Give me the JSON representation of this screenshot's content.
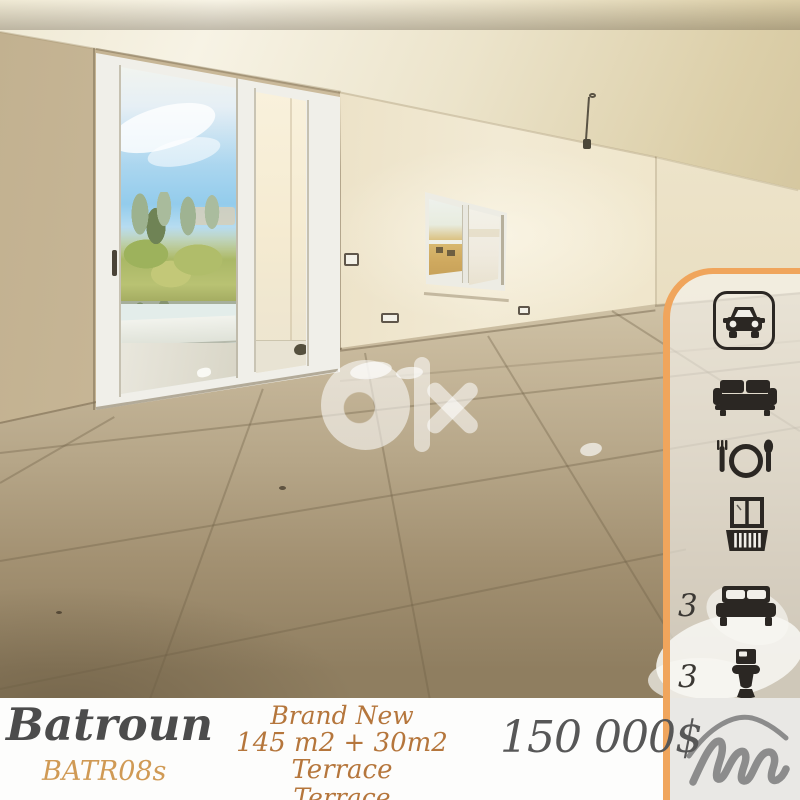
{
  "watermark": {
    "text": "Olx"
  },
  "listing": {
    "location": "Batroun",
    "reference": "BATR08s",
    "description_lines": [
      "Brand New",
      "145 m2 + 30m2 Terrace",
      "Terrace"
    ],
    "price": "150 000$"
  },
  "features": {
    "bedrooms": "3",
    "bathrooms": "3",
    "icons": [
      "car-icon",
      "sofa-icon",
      "dining-icon",
      "balcony-icon",
      "bed-icon",
      "toilet-icon"
    ]
  },
  "colors": {
    "accent_orange": "#f0a55c",
    "icon_dark": "#2b2723",
    "price_gray": "#575757",
    "code_gold": "#d09a55",
    "description_brown": "#b5763c",
    "title_gray": "#4c4c4c",
    "panel_footer_gray": "#e9e8e5",
    "logo_gray": "#8c8c8c"
  }
}
